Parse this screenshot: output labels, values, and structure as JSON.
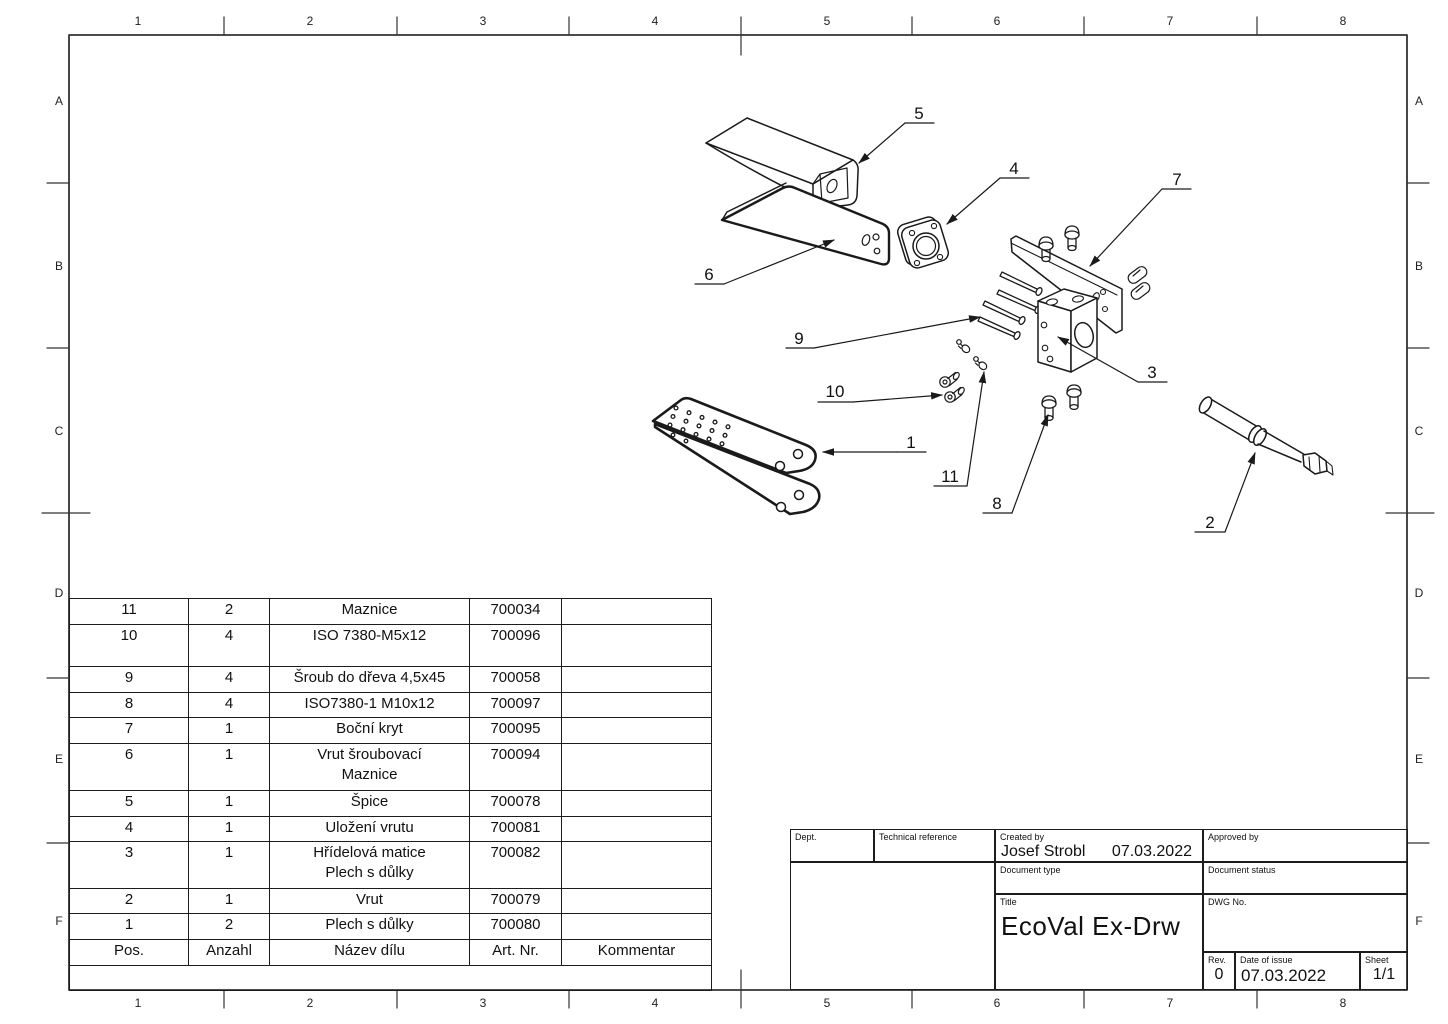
{
  "colors": {
    "line": "#1a1a1a",
    "background": "#ffffff"
  },
  "border": {
    "columns": [
      "1",
      "2",
      "3",
      "4",
      "5",
      "6",
      "7",
      "8"
    ],
    "rows": [
      "A",
      "B",
      "C",
      "D",
      "E",
      "F"
    ]
  },
  "drawing": {
    "callouts": [
      {
        "label": "1"
      },
      {
        "label": "2"
      },
      {
        "label": "3"
      },
      {
        "label": "4"
      },
      {
        "label": "5"
      },
      {
        "label": "6"
      },
      {
        "label": "7"
      },
      {
        "label": "8"
      },
      {
        "label": "9"
      },
      {
        "label": "10"
      },
      {
        "label": "11"
      }
    ]
  },
  "bom": {
    "header": {
      "pos": "Pos.",
      "qty": "Anzahl",
      "name": "Název dílu",
      "art": "Art. Nr.",
      "comment": "Kommentar"
    },
    "rows": [
      {
        "pos": "11",
        "qty": "2",
        "name": "Maznice",
        "name2": "",
        "art": "700034",
        "comment": ""
      },
      {
        "pos": "10",
        "qty": "4",
        "name": "ISO 7380-M5x12",
        "name2": "",
        "art": "700096",
        "comment": ""
      },
      {
        "pos": "9",
        "qty": "4",
        "name": "Šroub do dřeva 4,5x45",
        "name2": "",
        "art": "700058",
        "comment": ""
      },
      {
        "pos": "8",
        "qty": "4",
        "name": "ISO7380-1 M10x12",
        "name2": "",
        "art": "700097",
        "comment": ""
      },
      {
        "pos": "7",
        "qty": "1",
        "name": "Boční kryt",
        "name2": "",
        "art": "700095",
        "comment": ""
      },
      {
        "pos": "6",
        "qty": "1",
        "name": "Vrut šroubovací",
        "name2": "Maznice",
        "art": "700094",
        "comment": ""
      },
      {
        "pos": "5",
        "qty": "1",
        "name": "Špice",
        "name2": "",
        "art": "700078",
        "comment": ""
      },
      {
        "pos": "4",
        "qty": "1",
        "name": "Uložení vrutu",
        "name2": "",
        "art": "700081",
        "comment": ""
      },
      {
        "pos": "3",
        "qty": "1",
        "name": "Hřídelová matice",
        "name2": "Plech s důlky",
        "art": "700082",
        "comment": ""
      },
      {
        "pos": "2",
        "qty": "1",
        "name": "Vrut",
        "name2": "",
        "art": "700079",
        "comment": ""
      },
      {
        "pos": "1",
        "qty": "2",
        "name": "Plech s důlky",
        "name2": "",
        "art": "700080",
        "comment": ""
      }
    ]
  },
  "title_block": {
    "dept_label": "Dept.",
    "tech_ref_label": "Technical reference",
    "created_by_label": "Created by",
    "created_by_name": "Josef Strobl",
    "created_by_date": "07.03.2022",
    "approved_by_label": "Approved by",
    "doc_type_label": "Document type",
    "doc_status_label": "Document status",
    "title_label": "Title",
    "title": "EcoVal Ex-Drw",
    "dwg_no_label": "DWG No.",
    "rev_label": "Rev.",
    "rev": "0",
    "date_of_issue_label": "Date of issue",
    "date_of_issue": "07.03.2022",
    "sheet_label": "Sheet",
    "sheet": "1/1"
  }
}
